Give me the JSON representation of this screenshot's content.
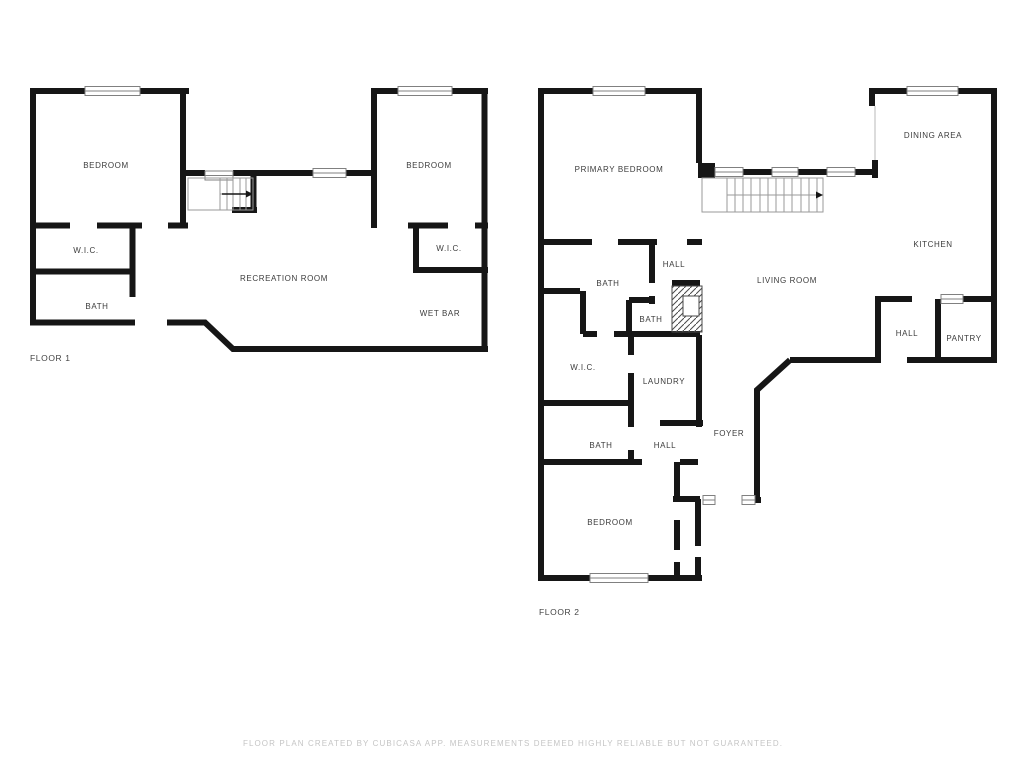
{
  "colors": {
    "wall": "#161616",
    "room_label": "#3c3c3c",
    "floor_label": "#444444",
    "footer_text": "#c5c5c5",
    "window_frame": "#808080",
    "stair_lines": "#9a9a9a"
  },
  "floor1": {
    "label": "FLOOR 1",
    "rooms": {
      "bedroom_left": "BEDROOM",
      "bedroom_right": "BEDROOM",
      "wic_left": "W.I.C.",
      "bath": "BATH",
      "recreation": "RECREATION ROOM",
      "wic_right": "W.I.C.",
      "wet_bar": "WET BAR"
    }
  },
  "floor2": {
    "label": "FLOOR 2",
    "rooms": {
      "primary_bedroom": "PRIMARY BEDROOM",
      "dining": "DINING AREA",
      "kitchen": "KITCHEN",
      "living": "LIVING ROOM",
      "hall_top": "HALL",
      "bath_top": "BATH",
      "bath_mid": "BATH",
      "wic": "W.I.C.",
      "laundry": "LAUNDRY",
      "foyer": "FOYER",
      "bath_bottom": "BATH",
      "hall_bottom": "HALL",
      "bedroom": "BEDROOM",
      "hall_right": "HALL",
      "pantry": "PANTRY"
    }
  },
  "footer": {
    "disclaimer": "FLOOR PLAN CREATED BY CUBICASA APP. MEASUREMENTS DEEMED HIGHLY RELIABLE BUT NOT GUARANTEED."
  }
}
